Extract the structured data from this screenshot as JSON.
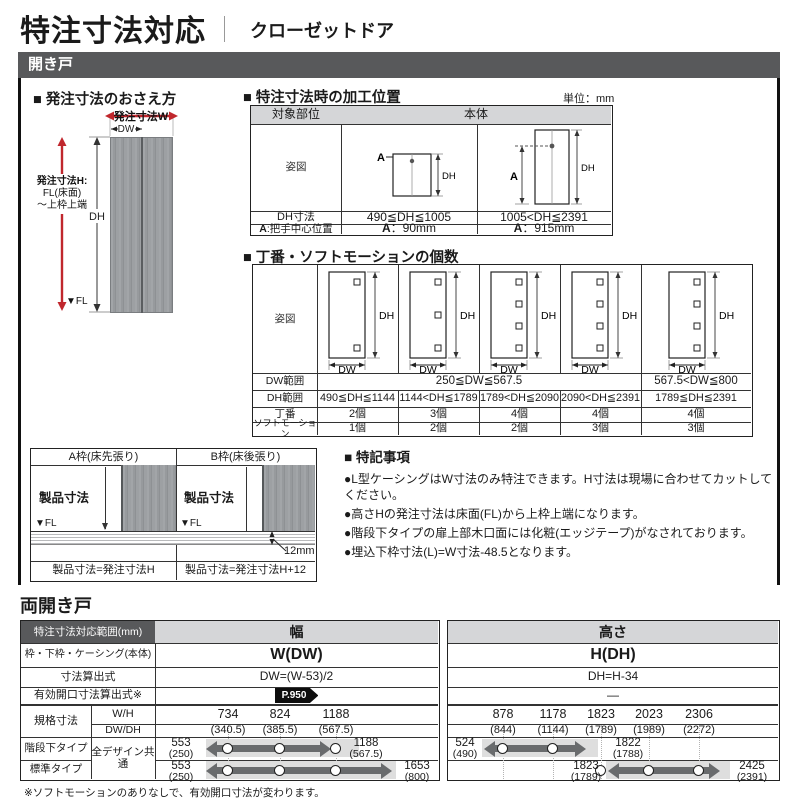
{
  "page": {
    "title": "特注寸法対応",
    "subtitle": "クローゼットドア"
  },
  "hinged": {
    "section_label": "開き戸",
    "order_diagram": {
      "heading": "■ 発注寸法のおさえ方",
      "order_w": "発注寸法W",
      "dw": "DW",
      "order_h1": "発注寸法H:",
      "order_h2": "FL(床面)",
      "order_h3": "～上枠上端",
      "dh": "DH",
      "fl": "▼FL"
    },
    "processing": {
      "heading": "■ 特注寸法時の加工位置",
      "unit": "単位：mm",
      "target_header": "対象部位",
      "body_header": "本体",
      "figure_label": "姿図",
      "dh_row_label": "DH寸法",
      "a_row_bold": "A",
      "a_row_rest": ":把手中心位置",
      "dh_ranges": [
        "490≦DH≦1005",
        "1005<DH≦2391"
      ],
      "a_bold": "A",
      "a_values": [
        "：90mm",
        "：915mm"
      ],
      "diag_a": "A",
      "diag_dh": "DH"
    },
    "hinges": {
      "heading": "■ 丁番・ソフトモーションの個数",
      "figure_label": "姿図",
      "dw_range_label": "DW範囲",
      "dh_range_label": "DH範囲",
      "hinge_label": "丁番",
      "soft_label": "ソフトモーション",
      "dh": "DH",
      "dw": "DW",
      "dw_ranges": [
        "250≦DW≦567.5",
        "567.5<DW≦800"
      ],
      "dh_ranges": [
        "490≦DH≦1144",
        "1144<DH≦1789",
        "1789<DH≦2090",
        "2090<DH≦2391",
        "1789≦DH≦2391"
      ],
      "hinge_counts": [
        "2個",
        "3個",
        "4個",
        "4個",
        "4個"
      ],
      "soft_counts": [
        "1個",
        "2個",
        "2個",
        "3個",
        "3個"
      ]
    },
    "frames": {
      "headers": [
        "A枠(床先張り)",
        "B枠(床後張り)"
      ],
      "product_dim": "製品寸法",
      "fl": "▼FL",
      "gap": "12mm",
      "formulas": [
        "製品寸法=発注寸法H",
        "製品寸法=発注寸法H+12"
      ]
    },
    "notes": {
      "heading": "■ 特記事項",
      "items": [
        "●L型ケーシングはW寸法のみ特注できます。H寸法は現場に合わせてカットしてください。",
        "●高さHの発注寸法は床面(FL)から上枠上端になります。",
        "●階段下タイプの扉上部木口面には化粧(エッジテープ)がなされております。",
        "●埋込下枠寸法(L)=W寸法-48.5となります。"
      ]
    }
  },
  "double": {
    "section_label": "両開き戸",
    "corner": "特注寸法対応範囲(mm)",
    "width_header": "幅",
    "height_header": "高さ",
    "frame_label": "枠・下枠・ケーシング(本体)",
    "frame_w": "W(DW)",
    "frame_h": "H(DH)",
    "formula_label": "寸法算出式",
    "formula_w": "DW=(W-53)/2",
    "formula_h": "DH=H-34",
    "opening_label": "有効開口寸法算出式※",
    "opening_badge": "P.950",
    "opening_h": "—",
    "std_label": "規格寸法",
    "wh_label": "W/H",
    "dwdh_label": "DW/DH",
    "w_sizes": [
      "734",
      "824",
      "1188"
    ],
    "w_subs": [
      "(340.5)",
      "(385.5)",
      "(567.5)"
    ],
    "h_sizes": [
      "878",
      "1178",
      "1823",
      "2023",
      "2306"
    ],
    "h_subs": [
      "(844)",
      "(1144)",
      "(1789)",
      "(1989)",
      "(2272)"
    ],
    "stair_label": "階段下タイプ",
    "normal_label": "標準タイプ",
    "shared_label": "全デザイン共通",
    "stair_w": {
      "min": "553",
      "min_sub": "(250)",
      "max": "1188",
      "max_sub": "(567.5)"
    },
    "normal_w": {
      "min": "553",
      "min_sub": "(250)",
      "max": "1653",
      "max_sub": "(800)"
    },
    "stair_h": {
      "min": "524",
      "min_sub": "(490)",
      "max": "1822",
      "max_sub": "(1788)"
    },
    "normal_h": {
      "min": "1823",
      "min_sub": "(1789)",
      "max": "2425",
      "max_sub": "(2391)"
    },
    "footnote": "※ソフトモーションのありなしで、有効開口寸法が変わります。"
  },
  "colors": {
    "accent_red": "#c0272d",
    "bar_gray": "#58595b",
    "header_gray": "#d5d6d8"
  }
}
